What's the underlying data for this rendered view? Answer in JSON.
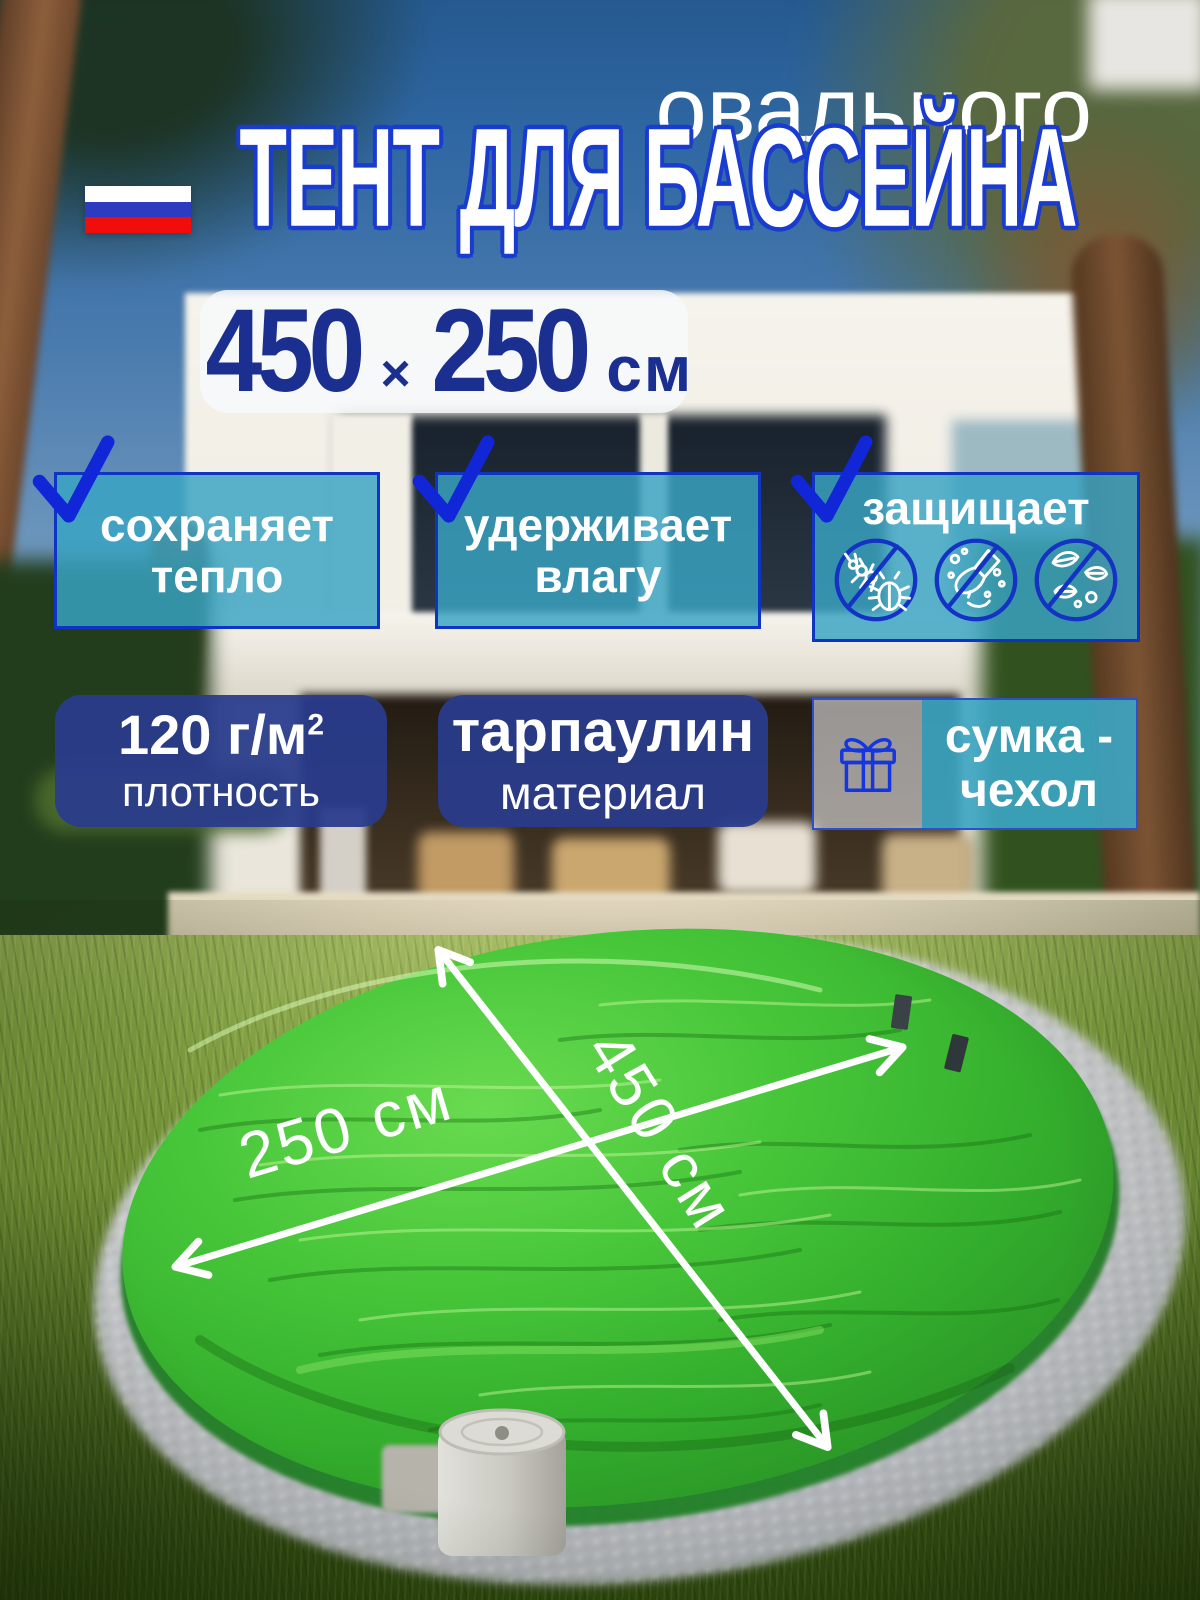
{
  "banner": {
    "kicker": "овального",
    "title": "ТЕНТ ДЛЯ БАССЕЙНА",
    "flag": {
      "name": "russia-flag-icon",
      "stripes": [
        "#ffffff",
        "#2d3bc1",
        "#f20d0d"
      ]
    },
    "size_badge": {
      "width_value": "450",
      "multiply_sign": "×",
      "height_value": "250",
      "unit": "см"
    }
  },
  "features": {
    "keeps_heat": {
      "line1": "сохраняет",
      "line2": "тепло",
      "check_icon": "check-icon"
    },
    "holds_moisture": {
      "line1": "удерживает",
      "line2": "влагу",
      "check_icon": "check-icon"
    },
    "protects": {
      "title": "защищает",
      "check_icon": "check-icon",
      "icons": [
        {
          "name": "no-insects-icon"
        },
        {
          "name": "no-dirt-icon"
        },
        {
          "name": "no-leaves-icon"
        }
      ]
    }
  },
  "specs": {
    "density": {
      "value": "120 г/м",
      "superscript": "2",
      "label": "плотность"
    },
    "material": {
      "value": "тарпаулин",
      "label": "материал"
    },
    "bag": {
      "line1": "сумка -",
      "line2": "чехол",
      "icon": "gift-icon"
    }
  },
  "photo": {
    "length_label": "250 см",
    "width_label": "450 см"
  },
  "colors": {
    "title_outline_blue": "#1a3bd0",
    "check_blue": "#1126d6",
    "circle_icon_blue": "#1433c4",
    "teal_box": "rgba(57,164,195,0.85)",
    "navy_box": "rgba(41,59,140,0.94)",
    "badge_text_blue": "#1b2f90",
    "tarp_green": "#3cb832",
    "arrow_white": "#ffffff"
  }
}
